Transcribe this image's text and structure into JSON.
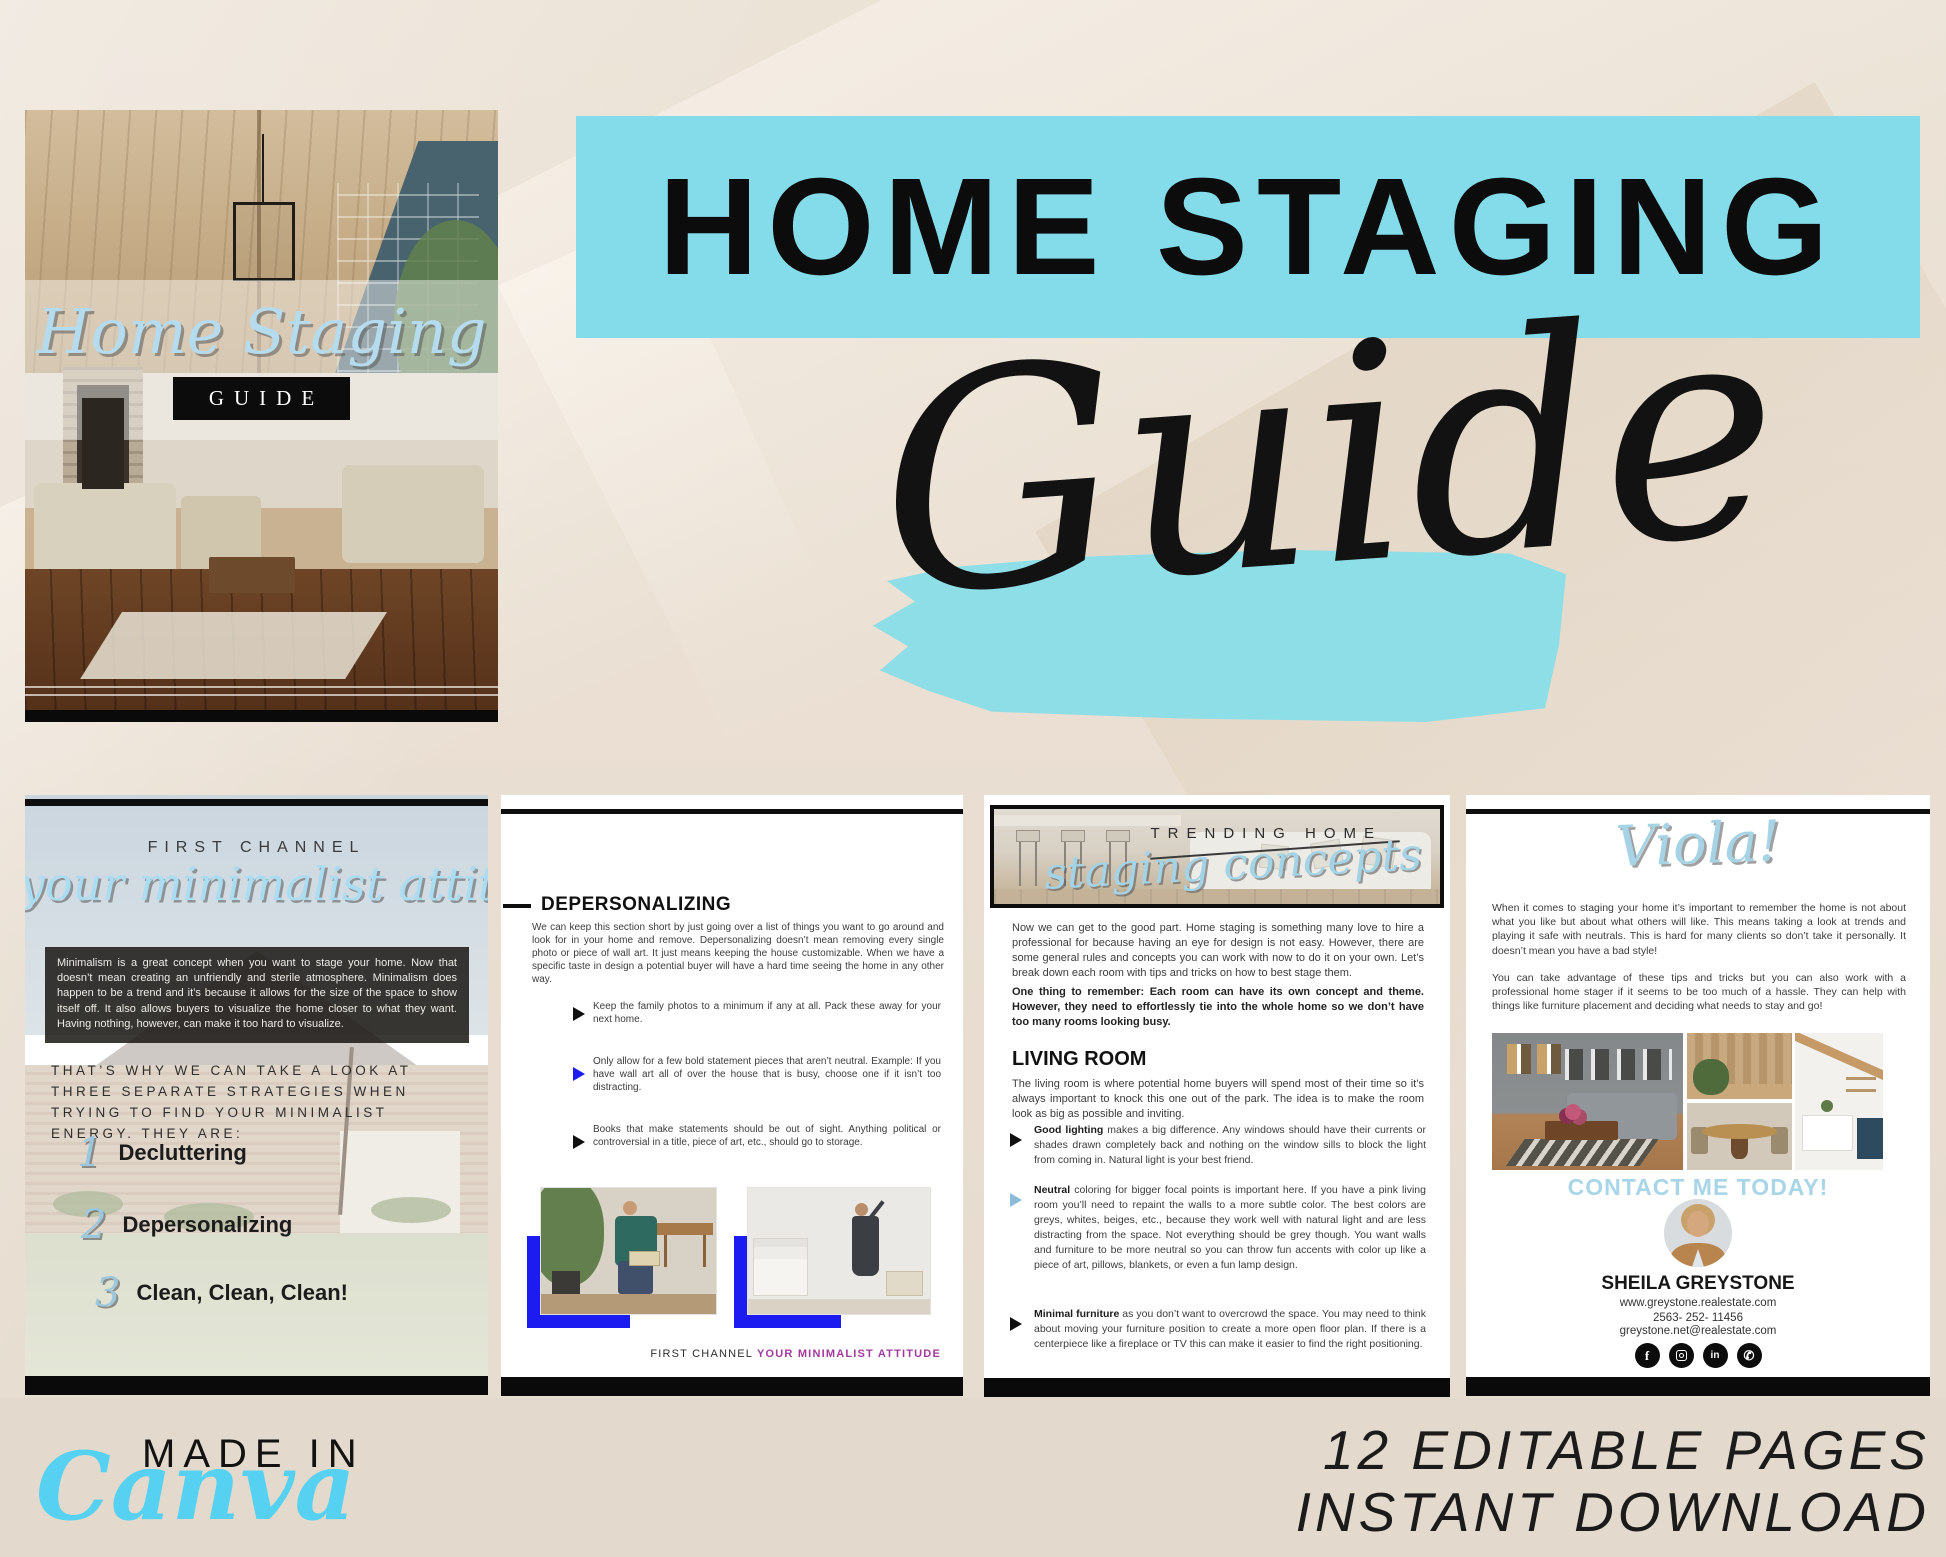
{
  "colors": {
    "cyan": "#84dcea",
    "cyan_brush": "#8edee8",
    "script_blue": "#b5dcee",
    "viola_blue": "#a6d4e6",
    "accent_blue": "#1c1cf0",
    "steel_blue": "#8cbcd8",
    "footer_purple": "#a13a9e",
    "contact_blue": "#a8d6e8",
    "canva_cyan": "#57d1f1"
  },
  "cover": {
    "script_title": "Home Staging",
    "guide_label": "GUIDE"
  },
  "hero": {
    "title": "HOME STAGING",
    "script_subtitle": "Guide"
  },
  "pages": {
    "page1": {
      "kicker": "FIRST CHANNEL",
      "script_title": "your minimalist attitude",
      "intro": "Minimalism is a great concept when you want to stage your home. Now that doesn’t mean creating an unfriendly and sterile atmosphere. Minimalism does happen to be a trend and it’s because it allows for the size of the space to show itself off. It also allows buyers to visualize the home closer to what they want. Having nothing, however, can make it too hard to visualize.",
      "lead": "THAT’S WHY WE CAN TAKE A LOOK AT THREE SEPARATE STRATEGIES WHEN TRYING TO FIND YOUR MINIMALIST ENERGY. THEY ARE:",
      "list": [
        {
          "num": "1",
          "label": "Decluttering"
        },
        {
          "num": "2",
          "label": "Depersonalizing"
        },
        {
          "num": "3",
          "label": "Clean, Clean, Clean!"
        }
      ]
    },
    "page2": {
      "heading": "DEPERSONALIZING",
      "intro": "We can keep this section short by just going over a list of things you want to go around and look for in your home and remove. Depersonalizing doesn’t mean removing every single photo or piece of wall art. It just means keeping the house customizable. When we have a specific taste in design a potential buyer will have a hard time seeing the home in any other way.",
      "bullets": [
        {
          "text": "Keep the family photos to a minimum if any at all. Pack these away for your next home."
        },
        {
          "text": "Only allow for a few bold statement pieces that aren’t neutral. Example: If you have wall art all of over the house that is busy, choose one if it isn’t too distracting."
        },
        {
          "text": "Books that make statements should be out of sight. Anything political or controversial in a title, piece of art, etc., should go to storage."
        }
      ],
      "footer_left": "FIRST CHANNEL ",
      "footer_right": "YOUR MINIMALIST ATTITUDE"
    },
    "page3": {
      "photo_kicker": "TRENDING HOME",
      "photo_script": "staging concepts",
      "intro": "Now we can get to the good part. Home staging is something many love to hire a professional for because having an eye for design is not easy. However, there are some general rules and concepts you can work with now to do it on your own. Let’s break down each room with tips and tricks on how to best stage them.",
      "reminder": "One thing to remember: Each room can have its own concept and theme. However, they need to effortlessly tie into the whole home so we don’t have too many rooms looking busy.",
      "living_heading": "LIVING ROOM",
      "living_intro": "The living room is where potential home buyers will spend most of their time so it’s always important to knock this one out of the park. The idea is to make the room look as big as possible and inviting.",
      "bullets": [
        {
          "bold": "Good lighting",
          "rest": " makes a big difference. Any windows should have their currents or shades drawn completely back and nothing on the window sills to block the light from coming in. Natural light is your best friend."
        },
        {
          "bold": "Neutral",
          "rest": " coloring for bigger focal points is important here. If you have a pink living room you’ll need to repaint the walls to a more subtle color. The best colors are greys, whites, beiges, etc., because they work well with natural light and are less distracting from the space. Not everything should be grey though. You want walls and furniture to be more neutral so you can throw fun accents with color up like a piece of art, pillows, blankets, or even a fun lamp design."
        },
        {
          "bold": "Minimal furniture",
          "rest": " as you don’t want to overcrowd the space. You may need to think about moving your furniture position to create a more open floor plan. If there is a centerpiece like a fireplace or TV this can make it easier to find the right positioning."
        }
      ]
    },
    "page4": {
      "script_title": "Viola!",
      "para1": "When it comes to staging your home it’s important to remember the home is not about what you like but about what others will like. This means taking a look at trends and playing it safe with neutrals. This is hard for many clients so don’t take it personally. It doesn’t mean you have a bad style!",
      "para2": "You can take advantage of these tips and tricks but you can also work with a professional home stager if it seems to be too much of a hassle. They can help with things like furniture placement and deciding what needs to stay and go!",
      "contact_cta": "CONTACT ME TODAY!",
      "name": "SHEILA GREYSTONE",
      "website": "www.greystone.realestate.com",
      "phone": "2563- 252- 11456",
      "email": "greystone.net@realestate.com",
      "social": [
        "facebook",
        "instagram",
        "linkedin",
        "whatsapp"
      ]
    }
  },
  "branding": {
    "made_in": "MADE IN",
    "canva": "Canva"
  },
  "promo": {
    "line1": "12 EDITABLE PAGES",
    "line2": "INSTANT DOWNLOAD"
  }
}
